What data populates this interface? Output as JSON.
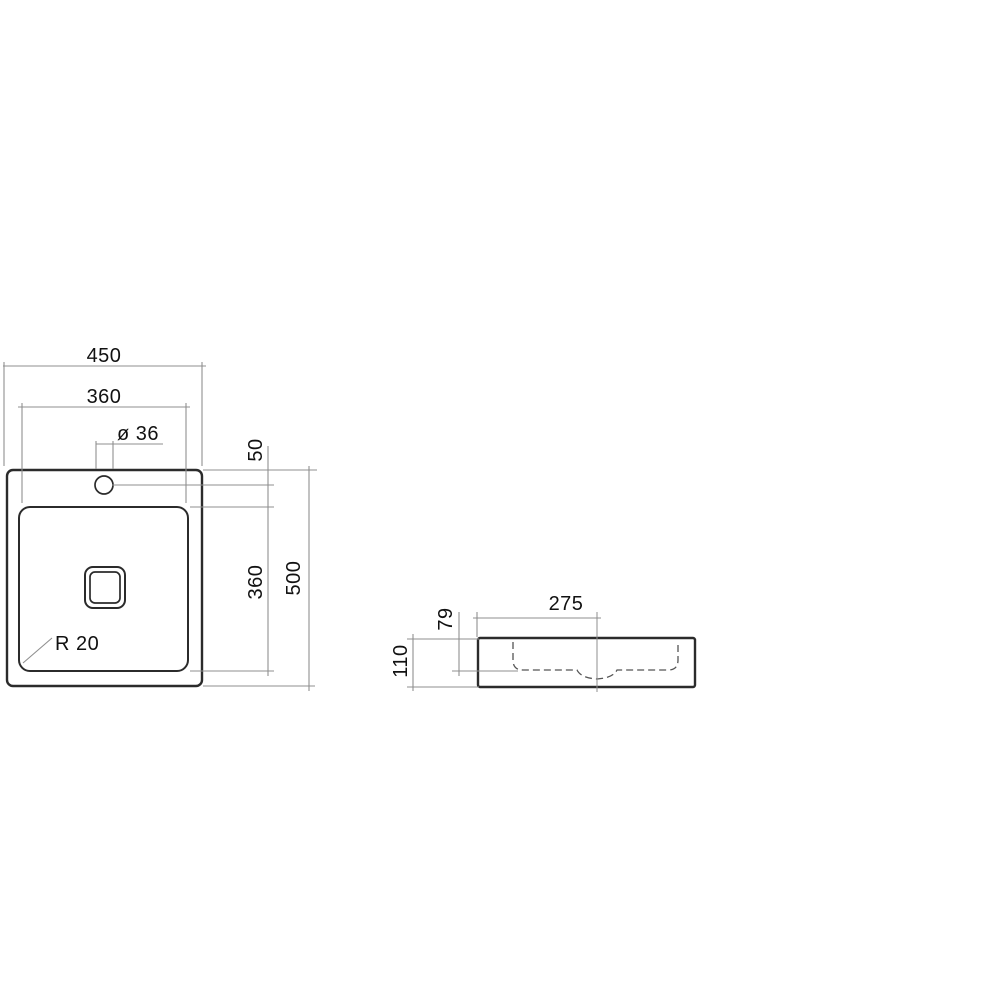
{
  "plan_view": {
    "overall_width": "450",
    "basin_width": "360",
    "faucet_hole_diameter": "ø 36",
    "faucet_hole_offset": "50",
    "basin_length": "360",
    "overall_depth": "500",
    "basin_corner_radius": "R 20"
  },
  "side_view": {
    "drain_center_offset": "275",
    "basin_inner_depth": "79",
    "overall_height": "110"
  },
  "colors": {
    "outline": "#2b2b2b",
    "dim": "#8f8f8f",
    "hidden": "#555555",
    "text": "#111111",
    "background": "#ffffff"
  }
}
